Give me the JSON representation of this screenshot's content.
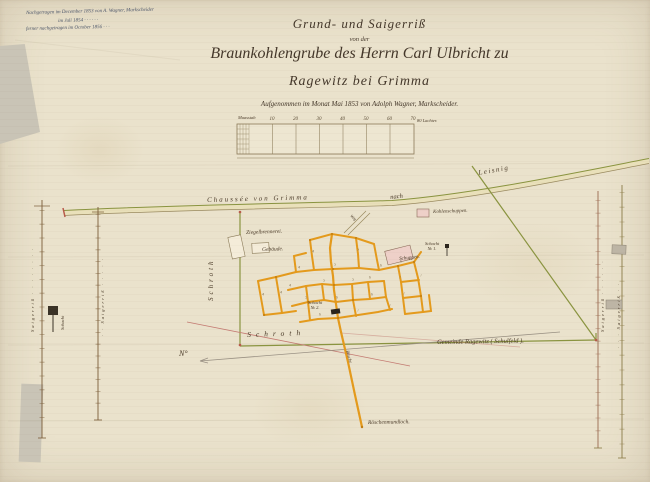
{
  "document": {
    "corner_note": {
      "line1": "Nachgetragen im December 1853 von A. Wagner, Markscheider",
      "line2": "im Juli 1854  ·  ·  ·  ·  ·  ·",
      "line3": "ferner nachgetragen im October 1856  ·  ·  ·"
    },
    "title": {
      "line1": "Grund- und Saigerriß",
      "line2": "von der",
      "line3": "Braunkohlengrube des Herrn Carl Ulbricht zu",
      "line4": "Ragewitz bei Grimma",
      "line5": "Aufgenommen im Monat Mai 1853 von Adolph Wagner, Markscheider."
    },
    "scale_bar": {
      "label_left": "Maasstab",
      "ticks": [
        "10",
        "20",
        "30",
        "40",
        "50",
        "60",
        "70"
      ],
      "label_right": "80 Lachter."
    }
  },
  "map": {
    "road": {
      "label": "Chaussée von Grimma",
      "label_nach": "nach",
      "destination": "Leisnig"
    },
    "labels": {
      "ziegelbrennerei": "Ziegelbrennerei.",
      "gebaeude": "Gebäude.",
      "kohlenschuppen": "Kohlenschuppen.",
      "schuppen": "Schuppen.",
      "schacht1_line1": "Schacht",
      "schacht1_line2": "№ 1.",
      "schacht2_line1": "Schacht",
      "schacht2_line2": "№ 2.",
      "weg": "Weg",
      "schroth_west": "Schroth",
      "schroth_sued": "Schroth",
      "gemeinde": "Gemeinde Ragewitz ( Schulfeld ).",
      "roesche": "Rösche",
      "roeschenmundloch": "Röschenmundloch.",
      "north_mark": "N°"
    },
    "margin_sections": {
      "left_a": "Saigerriß · · · · · · · ·",
      "left_b": "· · Saigerriß · · · · ·",
      "left_schacht": "Schacht",
      "right_a": "Saigerriß · · · · · ·",
      "right_b": "· · · Saigerriß · ·"
    },
    "gallery_node_marks": [
      {
        "x": 312,
        "y": 250,
        "t": "4"
      },
      {
        "x": 357,
        "y": 248,
        "t": "5"
      },
      {
        "x": 298,
        "y": 266,
        "t": "4"
      },
      {
        "x": 334,
        "y": 263,
        "t": "5"
      },
      {
        "x": 380,
        "y": 264,
        "t": "6"
      },
      {
        "x": 400,
        "y": 260,
        "t": "6"
      },
      {
        "x": 416,
        "y": 256,
        "t": "7"
      },
      {
        "x": 289,
        "y": 284,
        "t": "4"
      },
      {
        "x": 323,
        "y": 279,
        "t": "5"
      },
      {
        "x": 352,
        "y": 278,
        "t": "5"
      },
      {
        "x": 369,
        "y": 276,
        "t": "6"
      },
      {
        "x": 399,
        "y": 276,
        "t": "7"
      },
      {
        "x": 420,
        "y": 274,
        "t": "7"
      },
      {
        "x": 305,
        "y": 296,
        "t": "5"
      },
      {
        "x": 336,
        "y": 296,
        "t": "6"
      },
      {
        "x": 371,
        "y": 293,
        "t": "6"
      },
      {
        "x": 403,
        "y": 292,
        "t": "7"
      },
      {
        "x": 319,
        "y": 313,
        "t": "6"
      },
      {
        "x": 357,
        "y": 309,
        "t": "7"
      },
      {
        "x": 389,
        "y": 304,
        "t": "7"
      },
      {
        "x": 262,
        "y": 293,
        "t": "4"
      },
      {
        "x": 280,
        "y": 291,
        "t": "4"
      }
    ],
    "colors": {
      "paper": "#eae2cc",
      "ink": "#4a3a28",
      "note_ink": "#4a5468",
      "gallery_orange": "#e49a1c",
      "boundary_green": "#8a9440",
      "building_pink": "#eed0c8",
      "survey_red": "#c47a72"
    }
  }
}
